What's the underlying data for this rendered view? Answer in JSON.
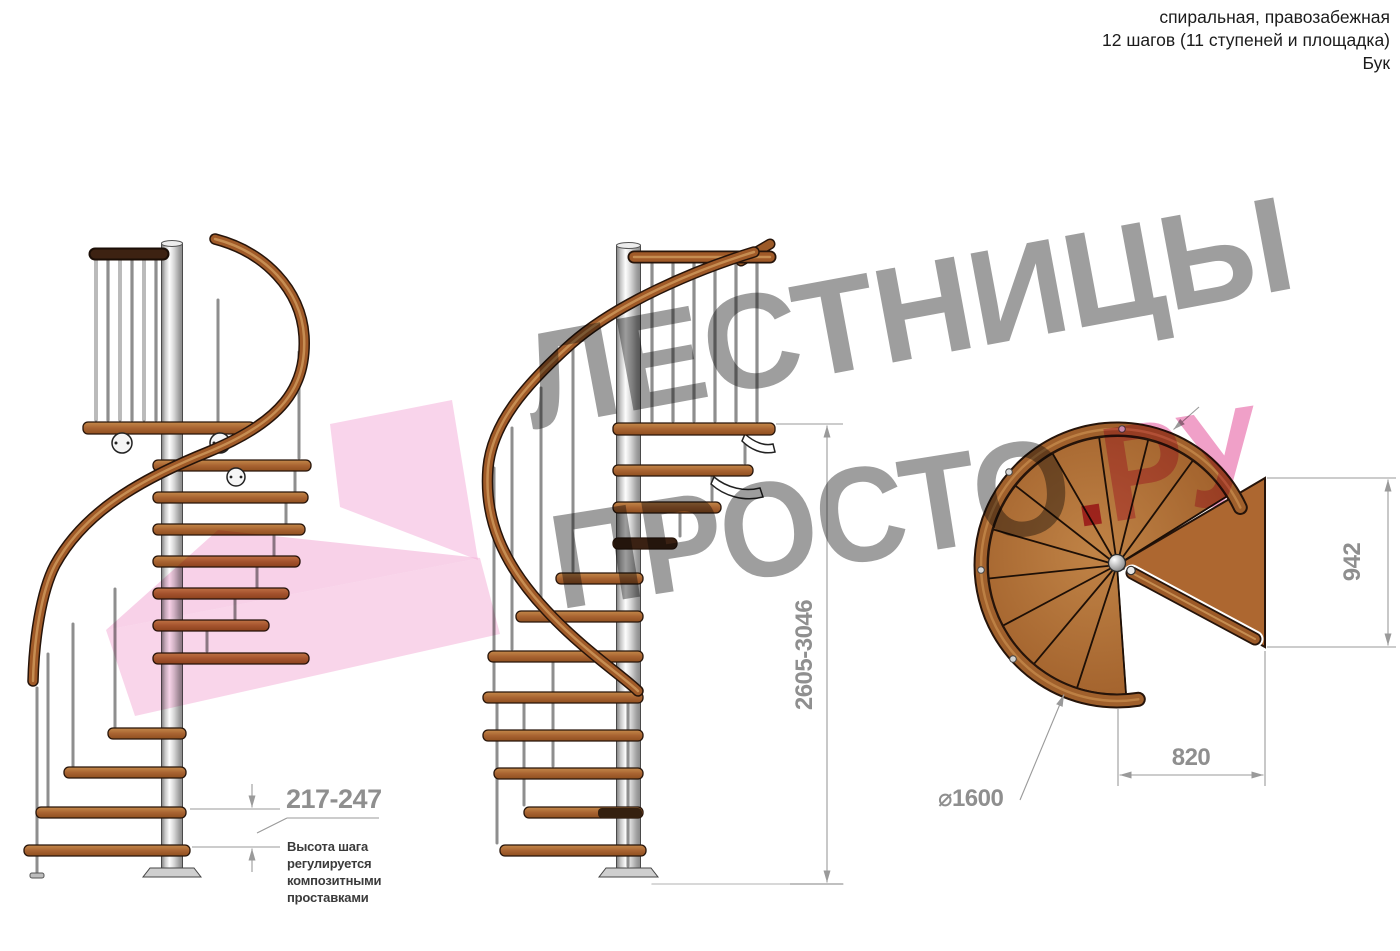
{
  "header": {
    "line1": "спиральная, правозабежная",
    "line2": "12 шагов (11 ступеней и площадка)",
    "line3": "Бук"
  },
  "dimensions": {
    "step_height": "217-247",
    "step_height_note": "Высота шага регулируется композитными проставками",
    "total_height": "2605-3046",
    "platform_depth": "942",
    "platform_width": "820",
    "diameter": "⌀1600"
  },
  "watermark": {
    "word1": "ЛЕСТНИЦЫ",
    "word2": "ПРОСТО",
    "dot": ".",
    "domain": "РУ"
  },
  "colors": {
    "wood": "#a4612b",
    "wood_light": "#c28747",
    "handrail": "#a05a28",
    "pole": "#d9d9d9",
    "dimension_gray": "#9a9a9a",
    "note_text": "#3b3b3b",
    "watermark_gray": "#9e9e9e",
    "watermark_pink": "#f0a0c8",
    "watermark_pink_dark": "#d8486f",
    "watermark_arrow_pink": "#f3abd6"
  }
}
